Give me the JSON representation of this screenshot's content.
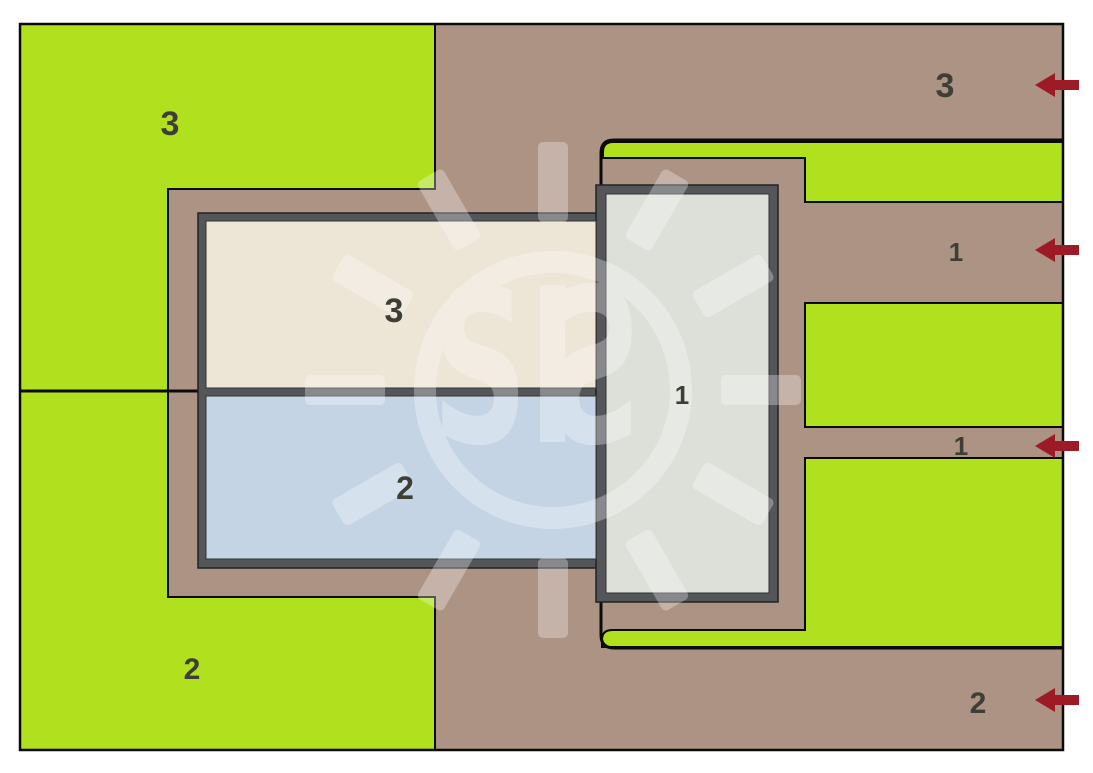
{
  "plan": {
    "labels": {
      "top_left_area": "3",
      "bottom_left_area": "2",
      "room_top": "3",
      "room_bottom": "2",
      "hall_right": "1",
      "top_right_area": "3",
      "upper_corridor": "1",
      "lower_corridor": "1",
      "bottom_right_area": "2"
    },
    "watermark": {
      "text": "SI",
      "mirrored_letter": "S"
    },
    "arrows": {
      "count": 4
    },
    "colors": {
      "page_background": "#FFFFFF",
      "ground": "#AC9384",
      "green": "#B1E01E",
      "building_border": "#55565A",
      "room_cream": "#EDE5D6",
      "room_blue": "#C4D4E5",
      "room_gray": "#DDE0D9",
      "outline": "#0B0B0B",
      "label": "#3E3E36",
      "arrow": "#9D1B27",
      "watermark": "#FFFFFF"
    }
  }
}
